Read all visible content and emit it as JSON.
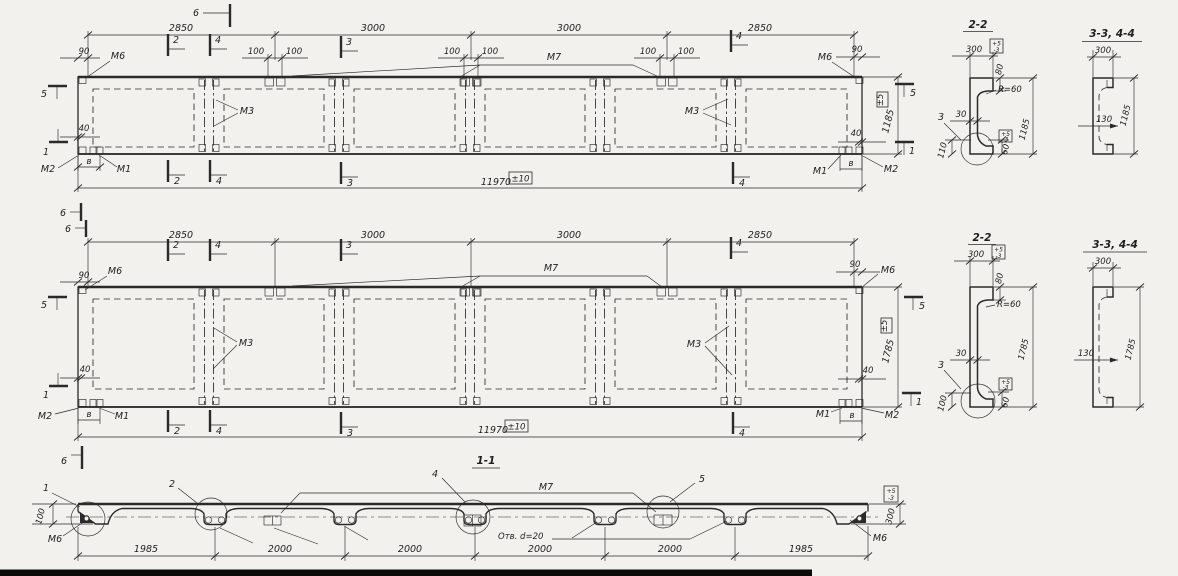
{
  "colors": {
    "paper": "#f2f1ed",
    "ink": "#2a2a2a",
    "scan_band": "#0b0b0b"
  },
  "plan_top": {
    "spans": [
      "2850",
      "3000",
      "3000",
      "2850"
    ],
    "total": "11970",
    "total_tol": "±10",
    "height": "1185",
    "height_tol": "±5",
    "edge_offset": "90",
    "corner_offset": "40",
    "anchor_spacing": "100",
    "m1": "М1",
    "m2": "М2",
    "m3": "М3",
    "m6": "М6",
    "m7": "М7",
    "v": "в",
    "marks": {
      "n1": "1",
      "n2": "2",
      "n3": "3",
      "n4": "4",
      "n5": "5",
      "n6": "6"
    }
  },
  "plan_middle": {
    "spans": [
      "2850",
      "3000",
      "3000",
      "2850"
    ],
    "total": "11970",
    "total_tol": "±10",
    "height": "1785",
    "height_tol": "±5",
    "edge_offset": "90",
    "corner_offset": "40",
    "m1": "М1",
    "m2": "М2",
    "m3": "М3",
    "m6": "М6",
    "m7": "М7",
    "v": "в",
    "marks": {
      "n1": "1",
      "n2": "2",
      "n3": "3",
      "n4": "4",
      "n5": "5",
      "n6": "6"
    }
  },
  "sec22_top": {
    "title": "2-2",
    "width": "300",
    "tol_plus": "+5",
    "tol_minus": "-3",
    "lip": "80",
    "radius": "R=60",
    "web": "30",
    "detail": "3",
    "foot": "110",
    "lip_bottom": "60",
    "height": "1185"
  },
  "sec22_bottom": {
    "title": "2-2",
    "width": "300",
    "tol_plus": "+5",
    "tol_minus": "-3",
    "lip": "80",
    "radius": "R=60",
    "web": "30",
    "detail": "3",
    "foot": "100",
    "lip_bottom": "60",
    "height": "1785"
  },
  "sec33_top": {
    "title": "3-3, 4-4",
    "width": "300",
    "web_offset": "130",
    "height": "1185"
  },
  "sec33_bottom": {
    "title": "3-3, 4-4",
    "width": "300",
    "web_offset": "130",
    "height": "1785"
  },
  "sec11": {
    "title": "1-1",
    "spans": [
      "1985",
      "2000",
      "2000",
      "2000",
      "2000",
      "1985"
    ],
    "thickness": "300",
    "tol_plus": "+5",
    "tol_minus": "-3",
    "end_height": "100",
    "holes_note": "Отв. d=20",
    "m6": "М6",
    "m7": "М7",
    "details": {
      "n1": "1",
      "n2": "2",
      "n4": "4",
      "n5": "5"
    },
    "mark6": "6"
  }
}
